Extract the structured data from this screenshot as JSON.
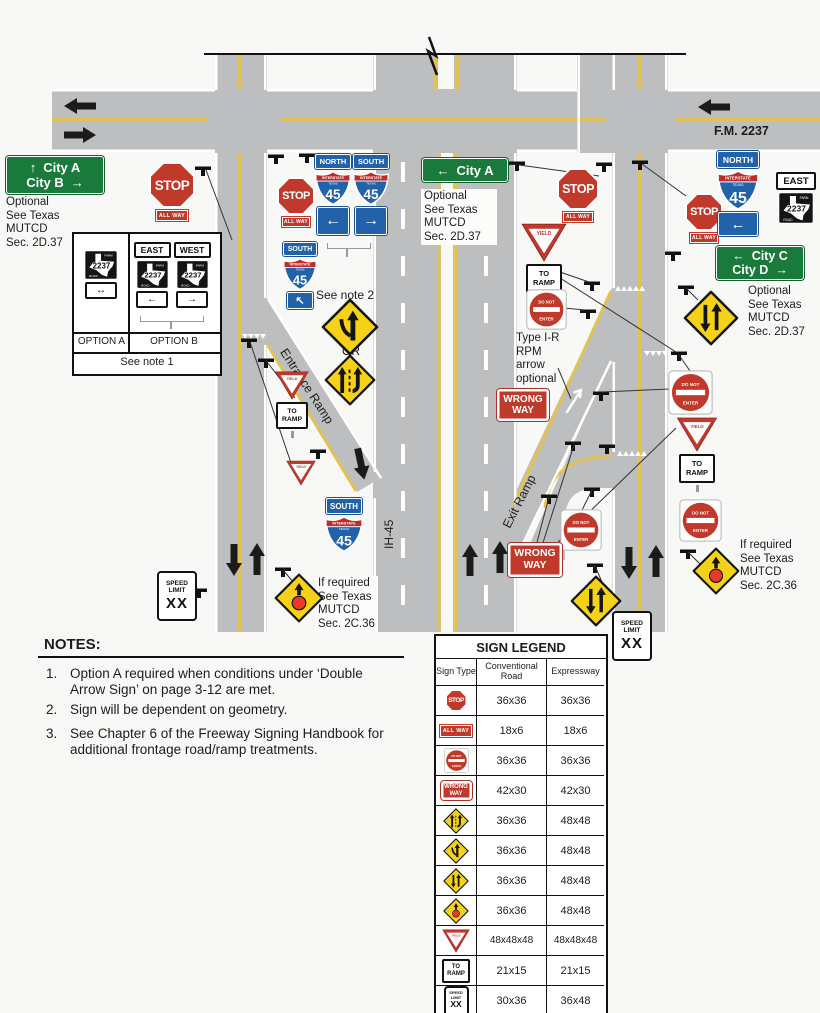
{
  "colors": {
    "road_gray": "#bdbebf",
    "lane_yellow": "#e3c254",
    "warning_yellow": "#f5d117",
    "sign_red": "#c0392b",
    "interstate_blue": "#2162ab",
    "guide_green": "#1a7a3c"
  },
  "labels": {
    "fm2237": "F.M. 2237",
    "entrance_ramp": "Entrance Ramp",
    "exit_ramp": "Exit Ramp",
    "ih45": "IH-45",
    "see_note_1": "See note 1",
    "see_note_2": "See note 2",
    "or": "OR",
    "option_a": "OPTION A",
    "option_b": "OPTION B",
    "optional_2d37": "Optional\nSee Texas\nMUTCD\nSec. 2D.37",
    "if_required_2c36": "If required\nSee Texas\nMUTCD\nSec. 2C.36",
    "type_ir_rpm": "Type I-R\nRPM\narrow\noptional"
  },
  "signs": {
    "stop": "STOP",
    "all_way": "ALL WAY",
    "yield": "YIELD",
    "do_not": "DO NOT",
    "enter": "ENTER",
    "wrong": "WRONG",
    "way": "WAY",
    "to": "TO",
    "ramp": "RAMP",
    "speed": "SPEED",
    "limit": "LIMIT",
    "xx": "XX",
    "north": "NORTH",
    "south": "SOUTH",
    "east": "EAST",
    "west": "WEST",
    "interstate": "INTERSTATE",
    "texas": "TEXAS",
    "route_45": "45",
    "farm": "FARM",
    "road": "ROAD",
    "route_2237": "2237",
    "arrow_up": "↑",
    "arrow_down": "↓",
    "arrow_left": "←",
    "arrow_right": "→",
    "arrow_up_left": "↖",
    "arrow_double": "↔"
  },
  "guide_signs": {
    "city_ab": {
      "arrow1": "↑",
      "line1": "City A",
      "line2": "City B",
      "arrow2": "→"
    },
    "city_a": {
      "arrow": "←",
      "text": "City A"
    },
    "city_cd": {
      "arrow1": "←",
      "line1": "City C",
      "line2": "City D",
      "arrow2": "→"
    }
  },
  "notes": {
    "heading": "NOTES:",
    "items": [
      {
        "num": "1.",
        "text": "Option A required when conditions under ‘Double Arrow Sign’ on page 3-12 are met."
      },
      {
        "num": "2.",
        "text": "Sign will be dependent on geometry."
      },
      {
        "num": "3.",
        "text": "See Chapter 6 of the Freeway Signing Handbook for additional frontage road/ramp treatments."
      }
    ]
  },
  "legend": {
    "title": "SIGN LEGEND",
    "columns": [
      "Sign Type",
      "Conventional Road",
      "Expressway"
    ],
    "rows": [
      {
        "sign": "stop-sign",
        "conventional": "36x36",
        "expressway": "36x36"
      },
      {
        "sign": "all-way-plaque",
        "conventional": "18x6",
        "expressway": "18x6"
      },
      {
        "sign": "do-not-enter-sign",
        "conventional": "36x36",
        "expressway": "36x36"
      },
      {
        "sign": "wrong-way-sign",
        "conventional": "42x30",
        "expressway": "42x30"
      },
      {
        "sign": "added-lane-sign",
        "conventional": "36x36",
        "expressway": "48x48"
      },
      {
        "sign": "merge-sign",
        "conventional": "36x36",
        "expressway": "48x48"
      },
      {
        "sign": "two-way-traffic-sign",
        "conventional": "36x36",
        "expressway": "48x48"
      },
      {
        "sign": "signal-ahead-sign",
        "conventional": "36x36",
        "expressway": "48x48"
      },
      {
        "sign": "yield-sign",
        "conventional": "48x48x48",
        "expressway": "48x48x48"
      },
      {
        "sign": "to-ramp-plaque",
        "conventional": "21x15",
        "expressway": "21x15"
      },
      {
        "sign": "speed-limit-sign",
        "conventional": "30x36",
        "expressway": "36x48"
      }
    ]
  }
}
